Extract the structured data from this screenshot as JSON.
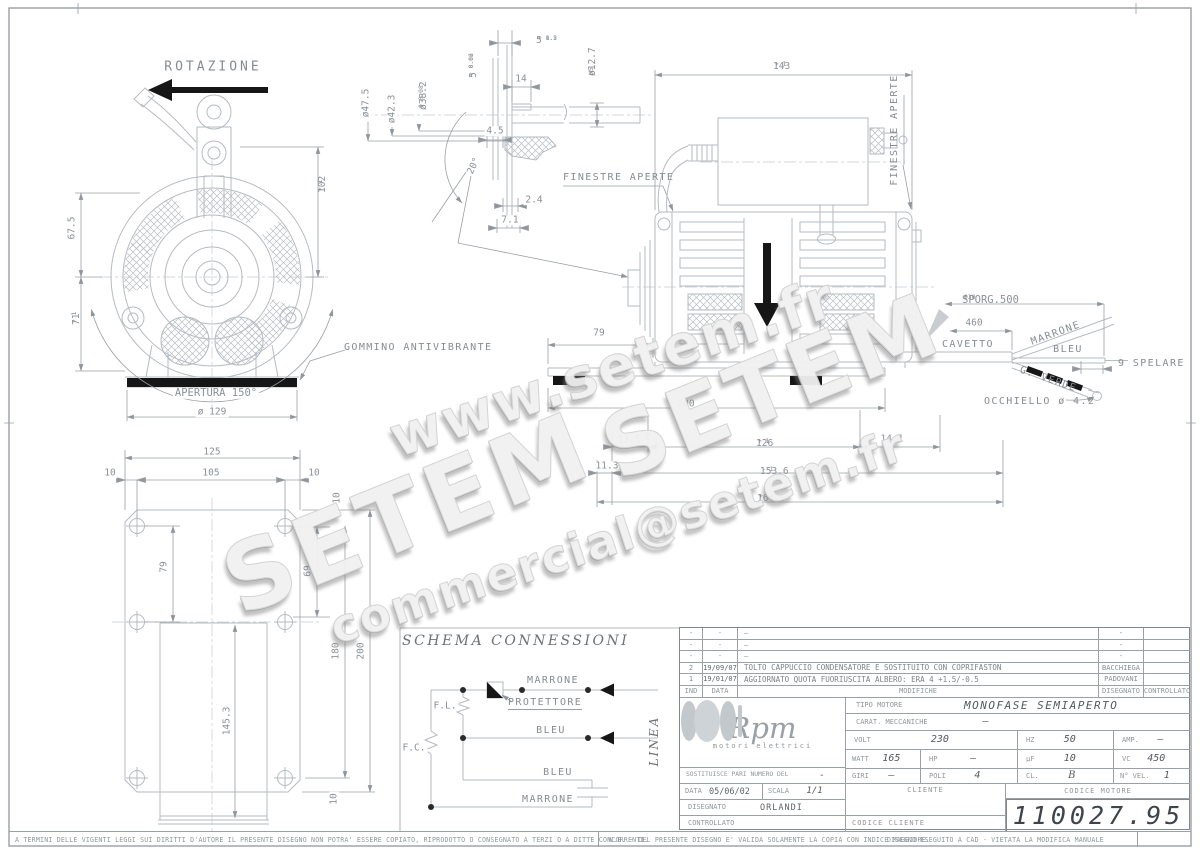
{
  "watermarks": {
    "site": "www.setem.fr",
    "brand1": "SETEM",
    "brand2": "SETEM",
    "email": "commercial@setem.fr"
  },
  "front": {
    "rotation": "ROTAZIONE",
    "d67_5": "67.5",
    "d71": {
      "v": "71",
      "up": "+ 1",
      "dn": "- 1"
    },
    "d102": {
      "v": "102",
      "up": "+ 1",
      "dn": "- 1"
    },
    "apertura": "APERTURA 150°",
    "d129": "ø 129",
    "gommino": "GOMMINO ANTIVIBRANTE"
  },
  "shaft": {
    "d47": "ø47.5",
    "d42": "ø42.3",
    "d38": {
      "v": "ø38.2",
      "up": "+ 0.08",
      "dn": "0"
    },
    "d5a": {
      "v": "5",
      "up": "+ 1.2",
      "dn": "- 0.5"
    },
    "d14": "14",
    "d12": {
      "v": "ø12.7",
      "sup": "H5"
    },
    "d5b": {
      "v": "5",
      "up": "+ 0.02",
      "dn": "- 0.06"
    },
    "d45": "4.5",
    "a20": "20°",
    "d24": "2.4",
    "d71": "7.1",
    "finestre": "FINESTRE APERTE"
  },
  "side": {
    "d143": {
      "v": "143",
      "up": "+ 1",
      "dn": "- 1"
    },
    "finestre": "FINESTRE APERTE",
    "d79": "79",
    "d200": "200",
    "d135": "13.5",
    "d126": {
      "v": "126",
      "up": "+ 1",
      "dn": "- 1"
    },
    "d141": "14.1",
    "d113": "11.3",
    "d1536": {
      "v": "153.6",
      "up": "- 1",
      "dn": ""
    },
    "d1649": {
      "v": "164.9",
      "up": "+ 1",
      "dn": "- 1"
    }
  },
  "cable": {
    "sporg": {
      "v": "SPORG.500",
      "up": "+30",
      "dn": "0"
    },
    "d460": "460",
    "cavetto": "CAVETTO",
    "marrone": "MARRONE",
    "bleu": "BLEU",
    "verde": "G. VERDE",
    "spelare": "9 SPELARE",
    "occhiello": "OCCHIELLO ø 4.2"
  },
  "plate": {
    "d125": "125",
    "d10l": "10",
    "d105": "105",
    "d10r": "10",
    "d10t": "10",
    "d79": "79",
    "d69": "69",
    "d180": "180",
    "d200": "200",
    "d1453": "145.3",
    "d10b": "10"
  },
  "schema": {
    "title": "SCHEMA CONNESSIONI",
    "fl": "F.L.",
    "fc": "F.C.",
    "protettore": "PROTETTORE",
    "marrone_top": "MARRONE",
    "bleu_mid": "BLEU",
    "bleu_bot": "BLEU",
    "marrone_bot": "MARRONE",
    "linea": "LINEA"
  },
  "titleblock": {
    "revisions": {
      "rows": [
        {
          "ind": "-",
          "date": "-",
          "desc": "—",
          "drawn": "-",
          "checked": ""
        },
        {
          "ind": "-",
          "date": "-",
          "desc": "—",
          "drawn": "-",
          "checked": ""
        },
        {
          "ind": "-",
          "date": "-",
          "desc": "—",
          "drawn": "-",
          "checked": ""
        },
        {
          "ind": "2",
          "date": "19/09/07",
          "desc": "TOLTO CAPPUCCIO CONDENSATORE E SOSTITUITO CON COPRIFASTON",
          "drawn": "BACCHIEGA",
          "checked": ""
        },
        {
          "ind": "1",
          "date": "19/01/07",
          "desc": "AGGIORNATO QUOTA FUORIUSCITA ALBERO: ERA 4 +1.5/-0.5",
          "drawn": "PADOVANI",
          "checked": ""
        }
      ],
      "header": {
        "ind": "IND",
        "date": "DATA",
        "desc": "MODIFICHE",
        "drawn": "DISEGNATO",
        "checked": "CONTROLLATO"
      }
    },
    "logo": {
      "name": "Rpm",
      "tagline": "motori elettrici"
    },
    "tipo_label": "TIPO MOTORE",
    "tipo_value": "MONOFASE SEMIAPERTO",
    "carat_label": "CARAT. MECCANICHE",
    "carat_value": "—",
    "volt_label": "VOLT",
    "volt": "230",
    "hz_label": "HZ",
    "hz": "50",
    "amp_label": "AMP.",
    "amp": "—",
    "watt_label": "WATT",
    "watt": "165",
    "hp_label": "HP",
    "hp": "—",
    "uf_label": "µF",
    "uf": "10",
    "vc_label": "VC",
    "vc": "450",
    "sost_label": "SOSTITUISCE PARI NUMERO DEL",
    "sost_value": "-",
    "giri_label": "GIRI",
    "giri": "—",
    "poli_label": "POLI",
    "poli": "4",
    "cl_label": "CL.",
    "cl": "B",
    "nvel_label": "N° VEL.",
    "nvel": "1",
    "data_label": "DATA",
    "data_value": "05/06/02",
    "scala_label": "SCALA",
    "scala_value": "1/1",
    "cliente_label": "CLIENTE",
    "codcli_label": "CODICE CLIENTE",
    "codmot_label": "CODICE MOTORE",
    "codmot_value": "110027.95",
    "disegnato_label": "DISEGNATO",
    "disegnato_value": "ORLANDI",
    "controllato_label": "CONTROLLATO"
  },
  "footer": {
    "left": "A TERMINI DELLE VIGENTI LEGGI SUI DIRITTI D'AUTORE IL PRESENTE DISEGNO NON POTRA' ESSERE COPIATO, RIPRODOTTO O CONSEGNATO A TERZI O A DITTE CONCORRENTI.",
    "mid": "N.B. - DEL PRESENTE DISEGNO E' VALIDA SOLAMENTE LA COPIA CON INDICE MAGGIORE.",
    "right": "DISEGNO ESEGUITO A CAD - VIETATA LA MODIFICA MANUALE"
  }
}
